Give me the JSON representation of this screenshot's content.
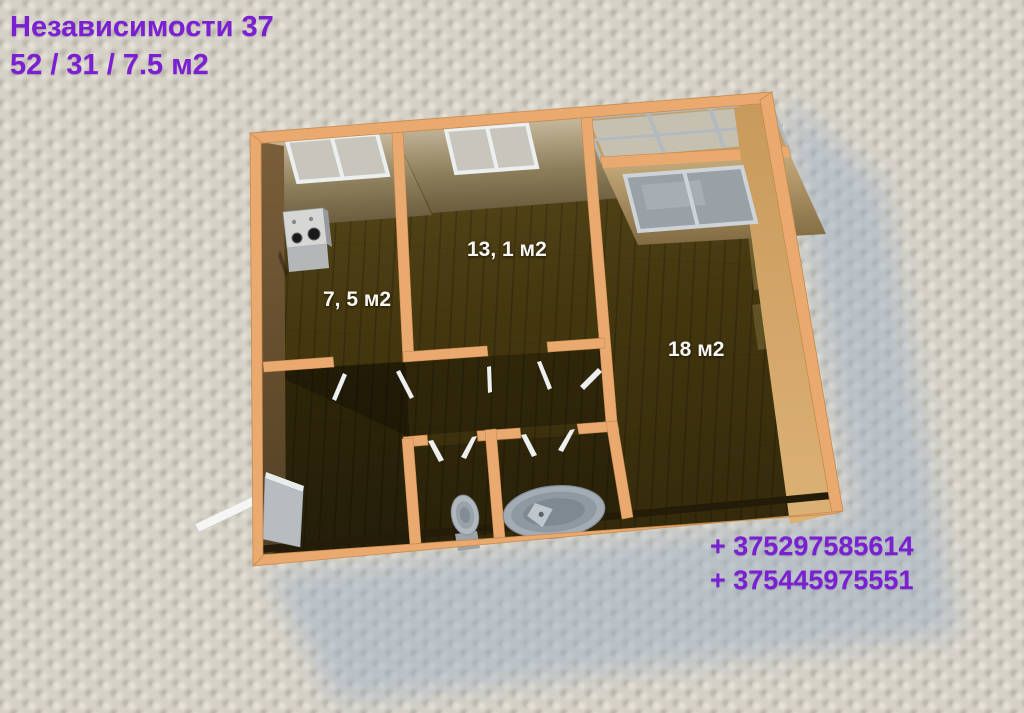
{
  "header": {
    "address": "Независимости 37",
    "areas": "52 / 31 / 7.5 м2"
  },
  "rooms": [
    {
      "name": "kitchen",
      "label": "7, 5 м2"
    },
    {
      "name": "room-13",
      "label": "13, 1 м2"
    },
    {
      "name": "room-18",
      "label": "18 м2"
    }
  ],
  "contacts": {
    "phone1": "+ 375297585614",
    "phone2": "+ 375445975551"
  },
  "plan_fixtures": [
    "stove",
    "toilet",
    "bathtub",
    "entrance-door",
    "windows",
    "balcony-glazing"
  ],
  "colors": {
    "accent_purple": "#7b1fd2",
    "wall_orange": "#e9a96f",
    "floor_brown": "#4a3b13",
    "room_label_white": "#f7f6f2",
    "shadow_blue": "#9db0c6",
    "wallpaper_gray": "#d5d1c7"
  }
}
